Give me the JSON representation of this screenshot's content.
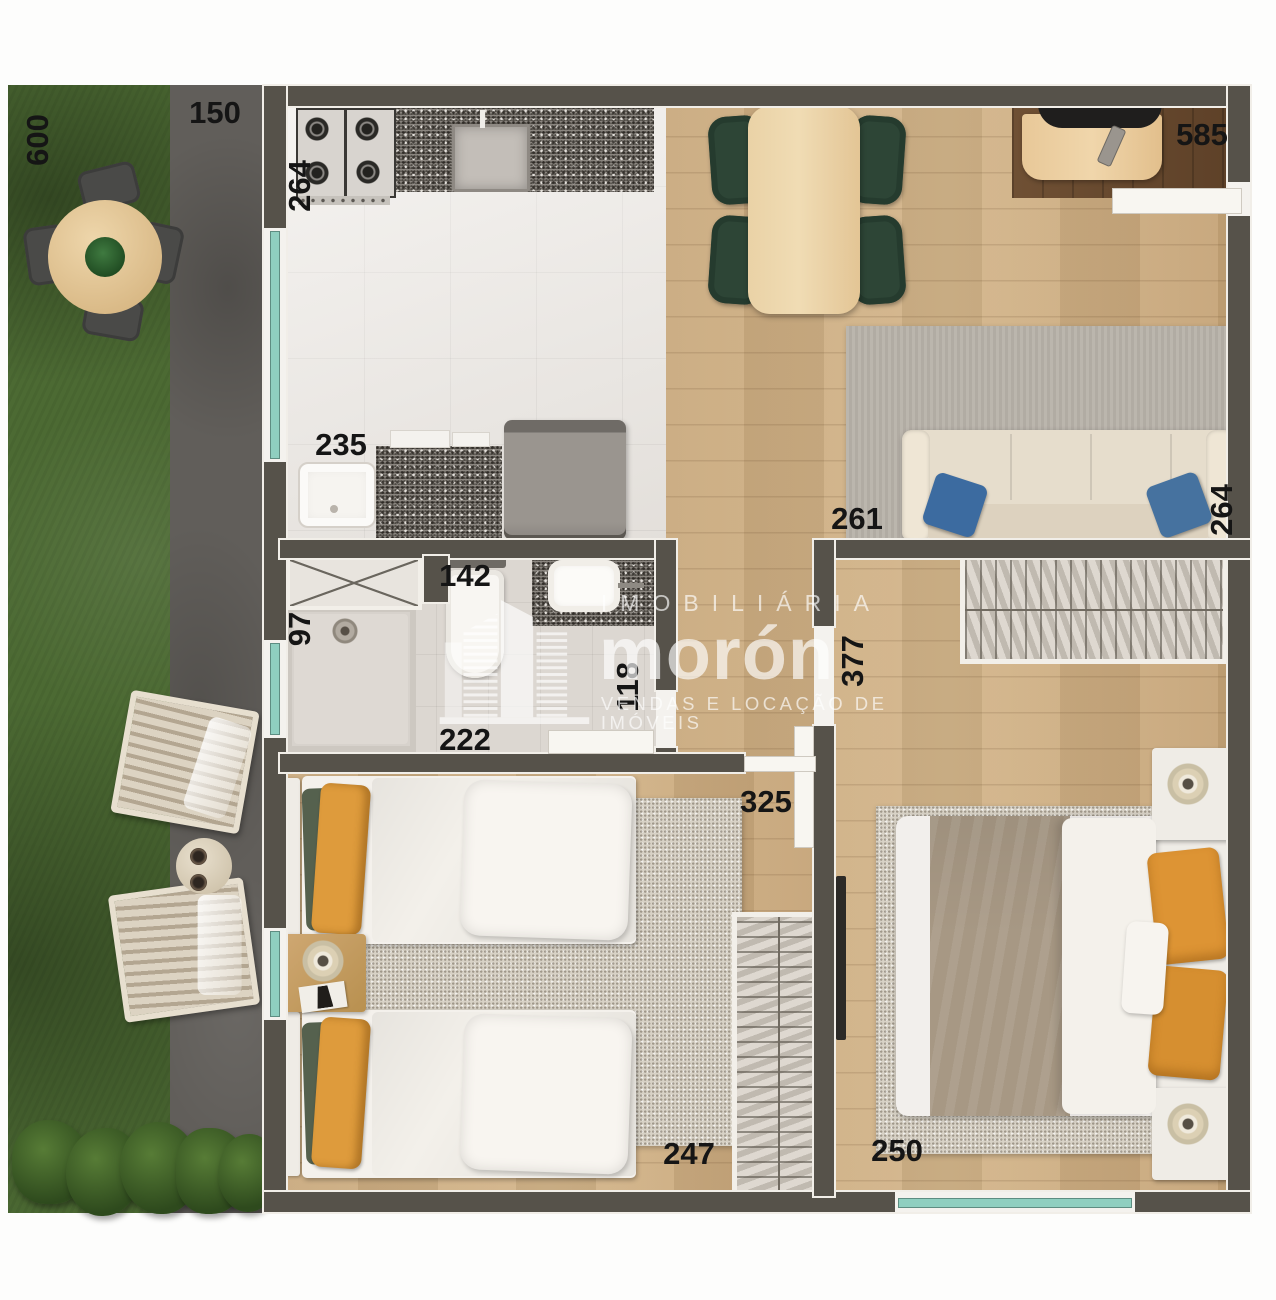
{
  "watermark": {
    "line1": "IMOBILIÁRIA",
    "brand": "morón",
    "line2": "VENDAS E LOCAÇÃO DE IMÓVEIS"
  },
  "labels": {
    "garden_depth": "600",
    "path_width": "150",
    "kitchen_width": "264",
    "laundry_width": "235",
    "shower_width": "97",
    "bath_width": "142",
    "bath_length": "222",
    "bath_side": "118",
    "living_width": "585",
    "living_left": "261",
    "living_depth": "264",
    "hall_depth": "377",
    "hall_width": "325",
    "bedroom1_width": "247",
    "bedroom2_width": "250"
  },
  "palette": {
    "grass_green": "#4c6a33",
    "concrete_grey": "#615e5a",
    "wall_grey": "#56524a",
    "wood_floor": "#c8a87c",
    "tile_white": "#ece8e3",
    "window_teal": "#8fcfc0",
    "accent_orange": "#de9b3c",
    "accent_green_chair": "#2d4536",
    "accent_blue_pillow": "#3c6ba0",
    "label_black": "#151515"
  }
}
